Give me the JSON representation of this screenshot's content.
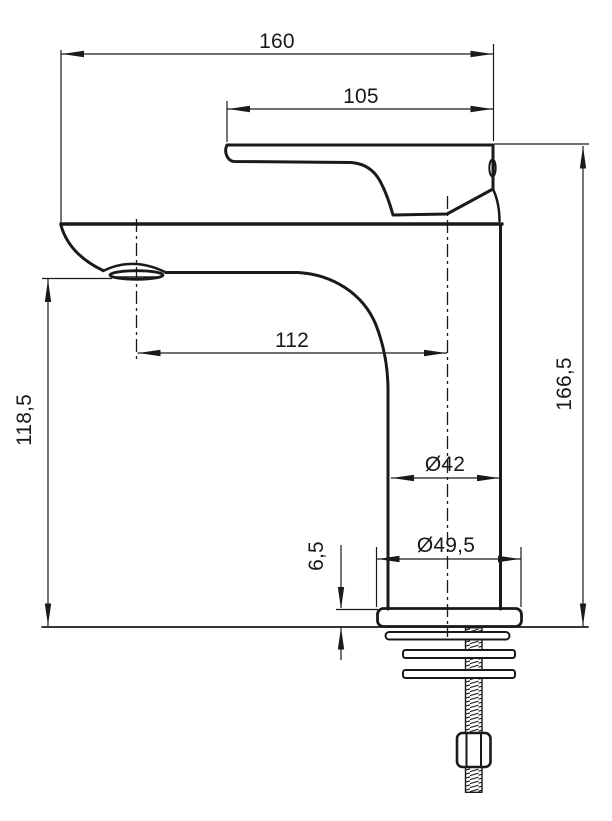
{
  "drawing": {
    "type": "technical-dimension-drawing",
    "subject": "single-lever basin mixer faucet, side elevation with mounting hardware",
    "unit": "mm",
    "colors": {
      "line": "#1a1a1a",
      "background": "#ffffff"
    },
    "dimensions": {
      "overall_width": "160",
      "handle_length": "105",
      "spout_reach": "112",
      "spout_outlet_height": "118,5",
      "overall_height": "166,5",
      "body_diameter": "Ø42",
      "base_diameter": "Ø49,5",
      "base_plate_height": "6,5"
    }
  }
}
